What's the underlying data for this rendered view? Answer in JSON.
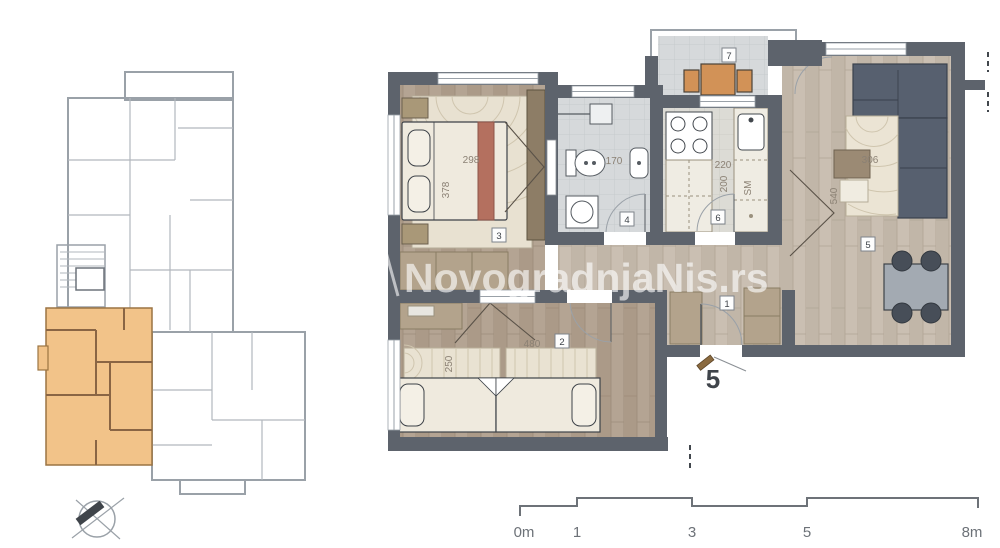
{
  "watermark": {
    "text": "NovogradnjaNis.rs"
  },
  "plan": {
    "apartment_label": "5",
    "room_labels": {
      "hallway": "1",
      "bedroom2": "2",
      "bedroom3": "3",
      "bathroom": "4",
      "living": "5",
      "kitchen": "6",
      "terrace": "7"
    },
    "dimensions": {
      "bedroom3_width": "298",
      "bedroom3_depth": "378",
      "bathroom_width": "170",
      "kitchen_width": "220",
      "kitchen_depth": "200",
      "dishwasher_label": "SM",
      "living_depth": "540",
      "living_rug_width": "306",
      "bedroom2_width": "480",
      "bedroom2_rug_depth": "250"
    }
  },
  "scalebar": {
    "labels": [
      "0m",
      "1",
      "3",
      "5",
      "8m"
    ]
  },
  "colors": {
    "wall_dark": "#5d636c",
    "wall_light": "#9aa1a8",
    "wood_dark": "#b4a493",
    "wood_light": "#c9bfb2",
    "tile": "#d6d9db",
    "highlight_apartment": "#f2c389",
    "terrace_wood": "#d29257",
    "sofa": "#57606f",
    "blanket_accent": "#b4705f"
  }
}
